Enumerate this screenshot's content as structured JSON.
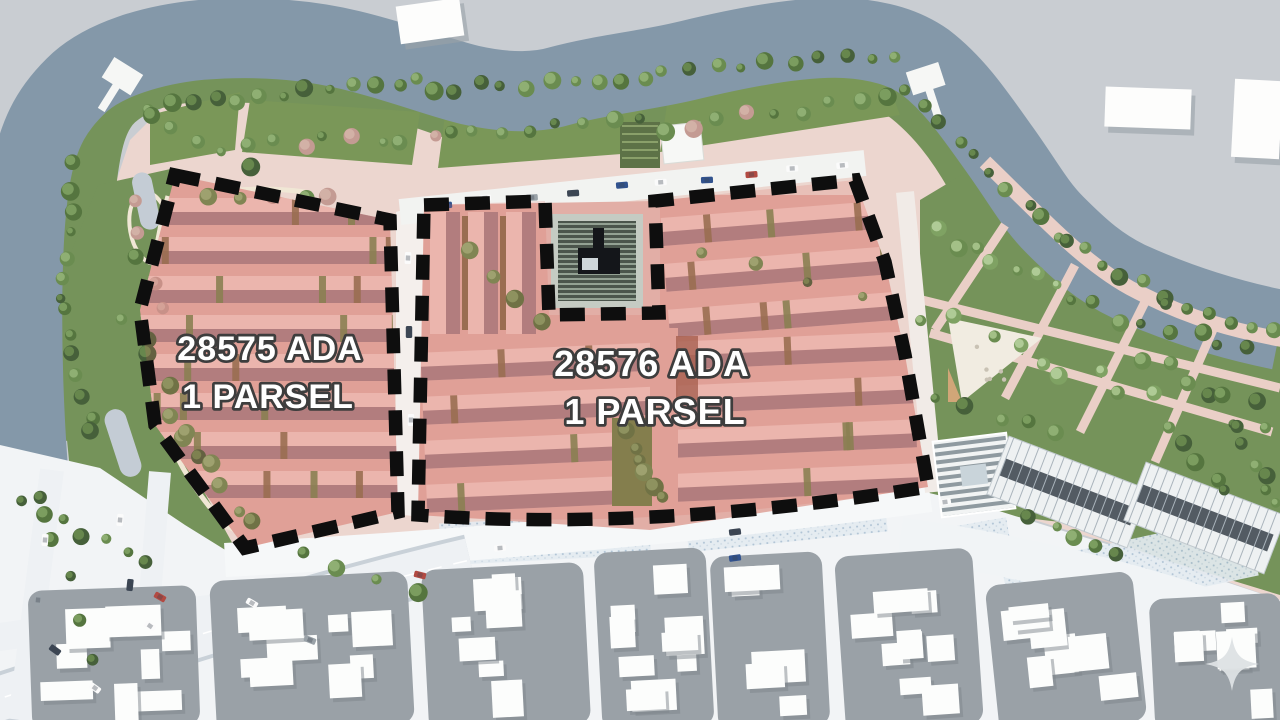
{
  "title": "Aerial site development plan rendering",
  "parcels": [
    {
      "block": "28575",
      "line1": "28575 ADA",
      "line2": "1 PARSEL"
    },
    {
      "block": "28576",
      "line1": "28576 ADA",
      "line2": "1 PARSEL"
    }
  ],
  "watermark": {
    "icon": "sparkle"
  },
  "colors": {
    "outside_land": "#c9cdd2",
    "water": "#8498a9",
    "park_green": "#75935a",
    "plaza_pink": "#ecd6cf",
    "parcel_ground": "#e2aea6",
    "building_light": "#efc9c1",
    "building_dark_band": "#9b767b",
    "garden_brown": "#8a6f4e",
    "garden_green": "#75854f",
    "parcel_tint": "rgba(221,106,95,0.20)",
    "boundary_dash": "#0e0e0e",
    "label_fill": "#ffffff",
    "label_stroke": "#3d3d3d",
    "city_block": "#9aa1a7",
    "city_building": "#fcfdfc",
    "road_white": "#f2f4f6",
    "dark_roof": "#4b554c",
    "pond": "#c4ccd5",
    "path_cream": "#f0e7d5",
    "speckle_lot": "#e4ebf1"
  }
}
